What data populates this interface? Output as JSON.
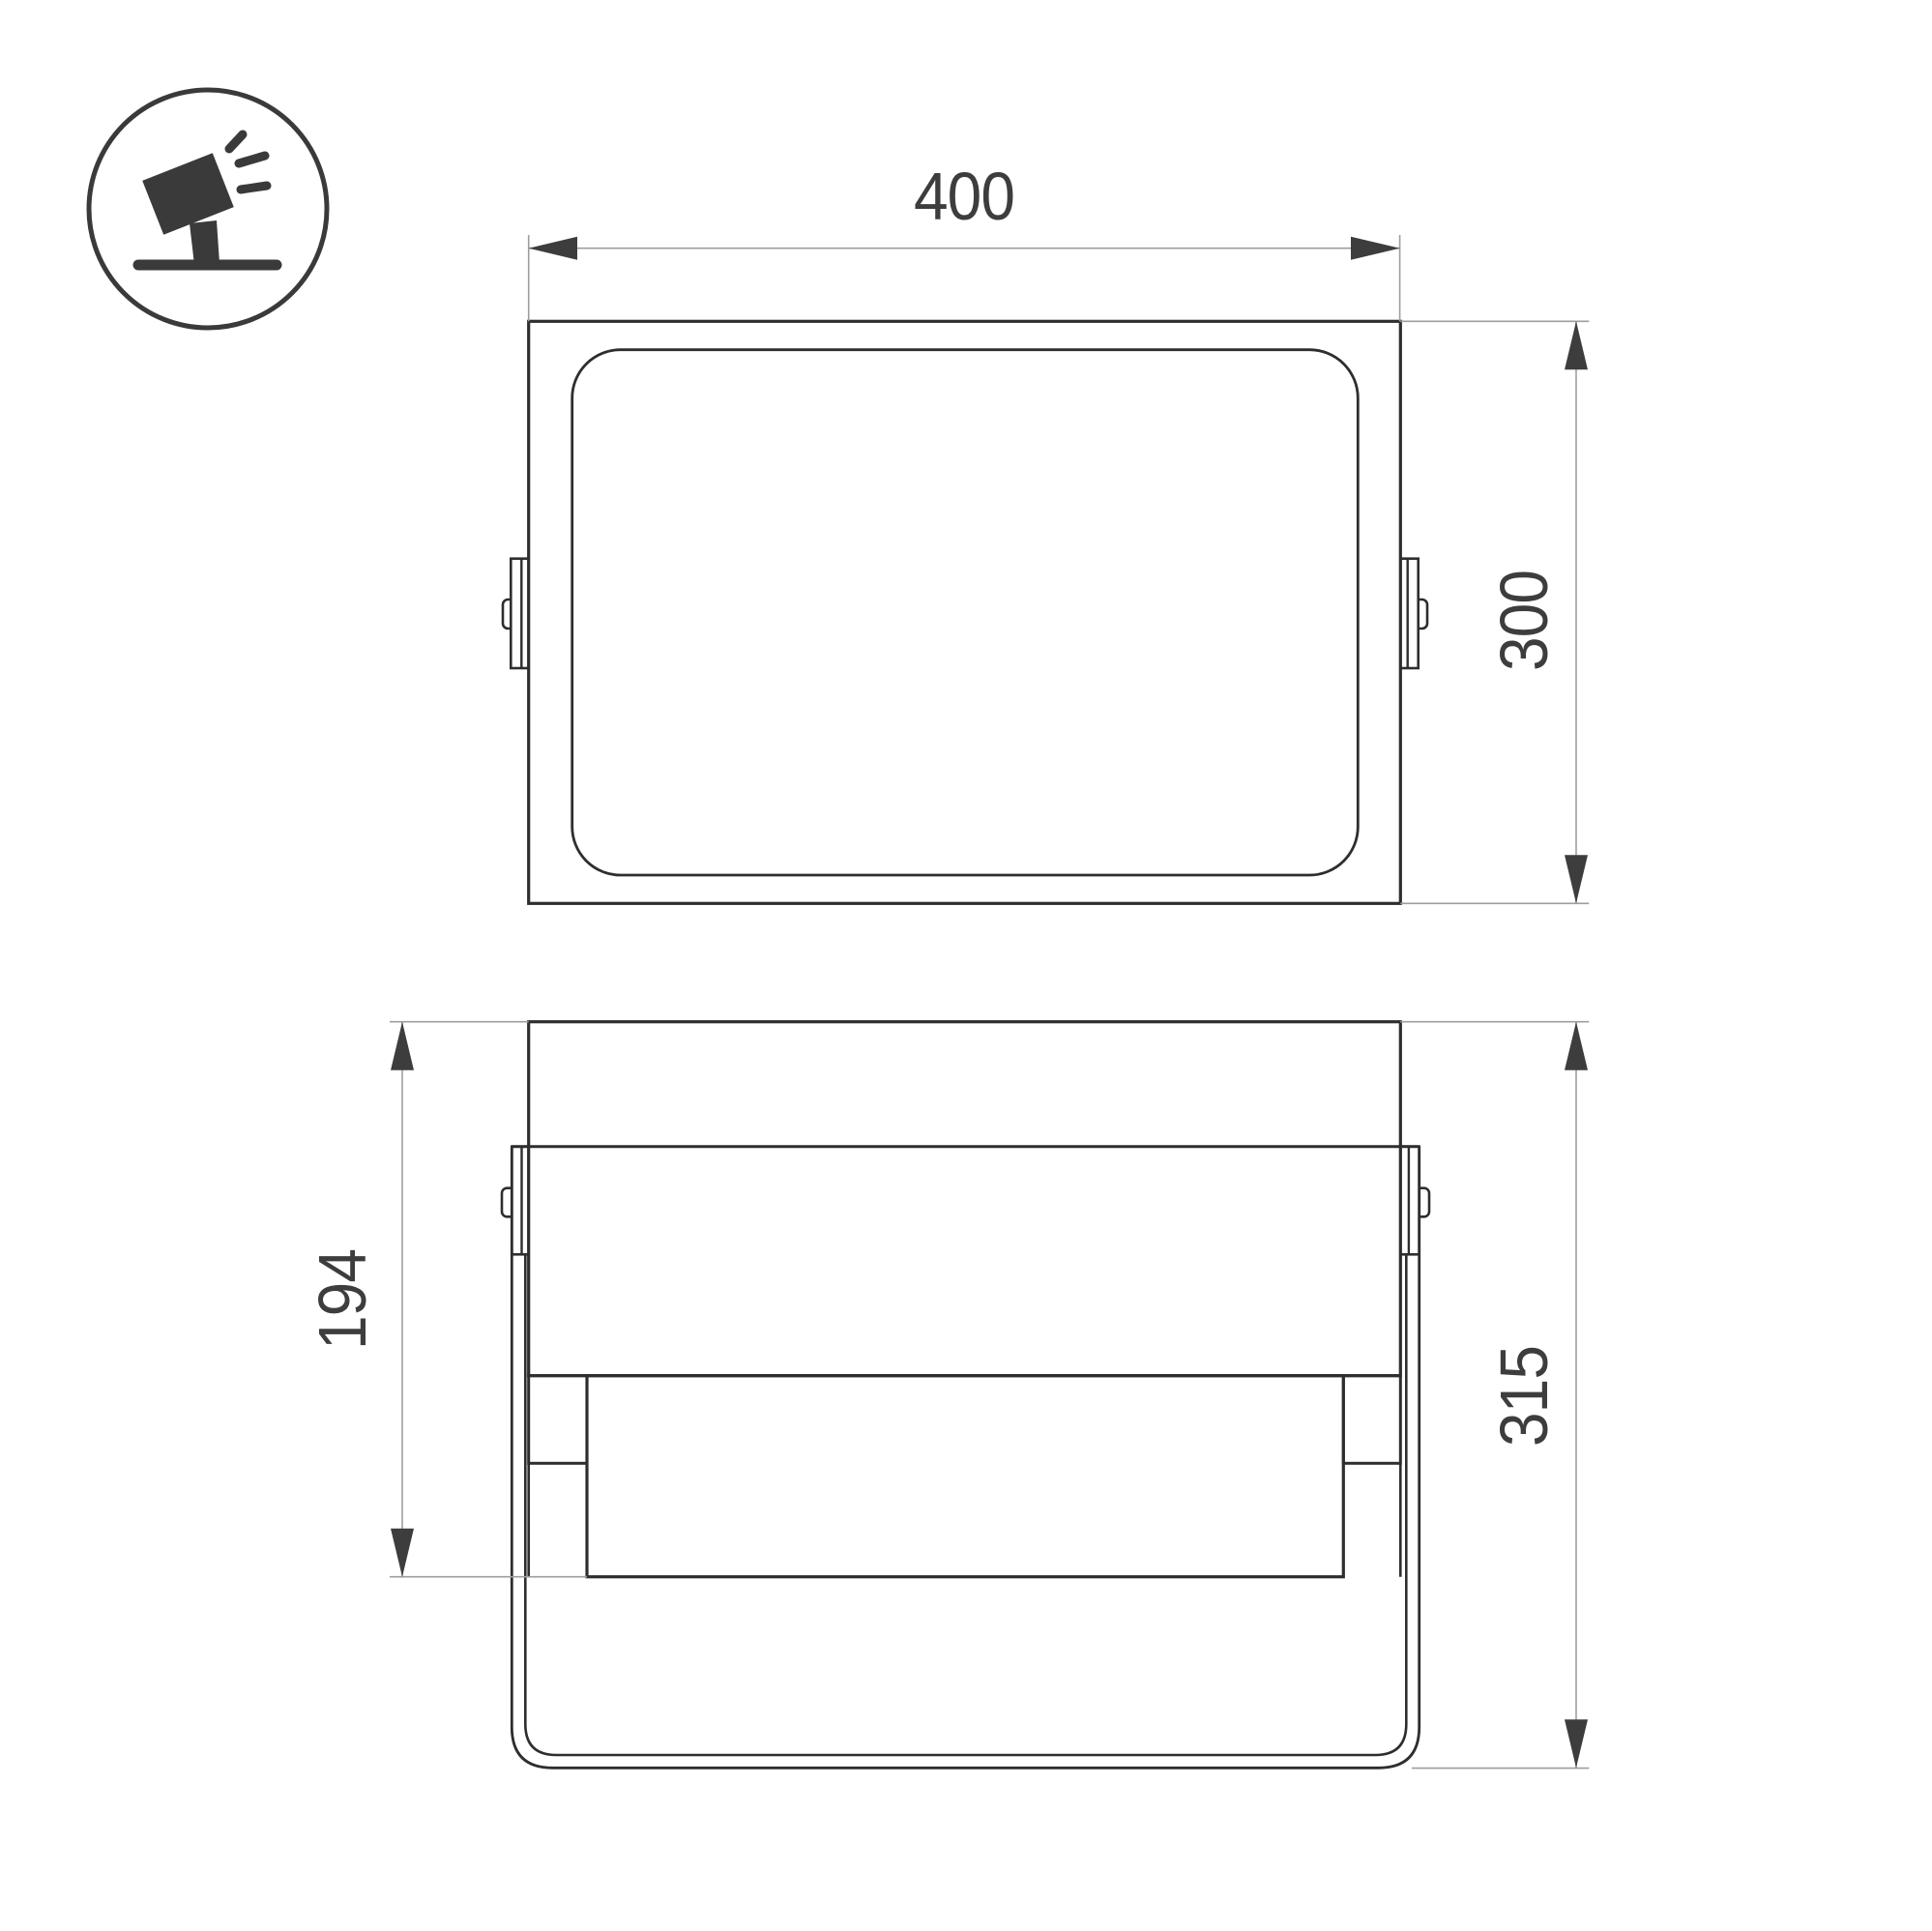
{
  "drawing": {
    "type": "technical-dimension-drawing",
    "subject": "floodlight-luminaire"
  },
  "icon": {
    "label": "tilted-floodlight-on-stand-icon"
  },
  "dimensions": {
    "front_width": "400",
    "front_height": "300",
    "side_body_height": "194",
    "side_total_height": "315"
  },
  "colors": {
    "background": "#ffffff",
    "outline": "#2e2e2e",
    "dimension_line": "#9e9e9e",
    "dimension_text_and_arrows": "#3d3d3d",
    "icon": "#3a3a3a"
  }
}
